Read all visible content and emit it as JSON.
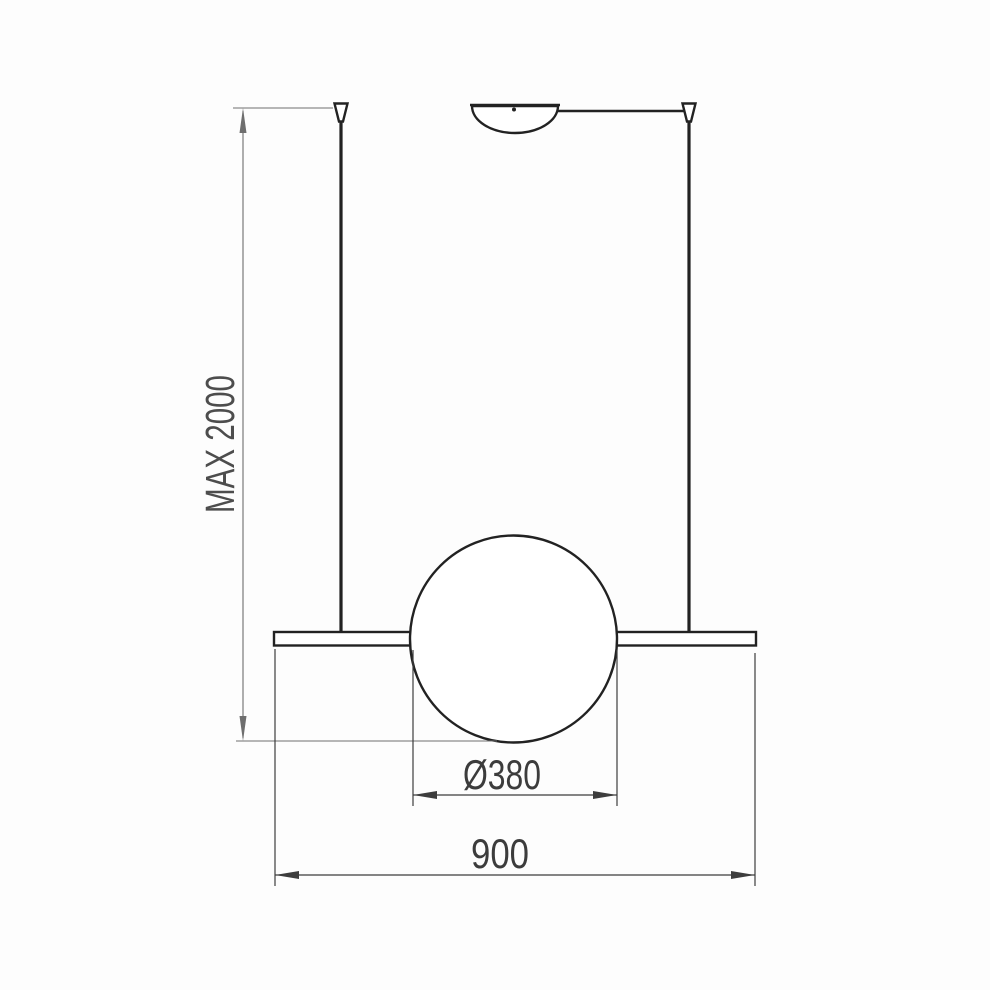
{
  "drawing": {
    "labels": {
      "max_suspension_height": "MAX 2000",
      "sphere_diameter": "Ø380",
      "bar_width": "900"
    },
    "colors": {
      "background": "#fdfdfd",
      "fixture_line": "#222222",
      "dimension_gray": "#6e6e6e",
      "dimension_dark": "#3d3d3d",
      "dimension_text": "#3c3c3c",
      "dimension_gray_text": "#4d4d4d"
    }
  }
}
